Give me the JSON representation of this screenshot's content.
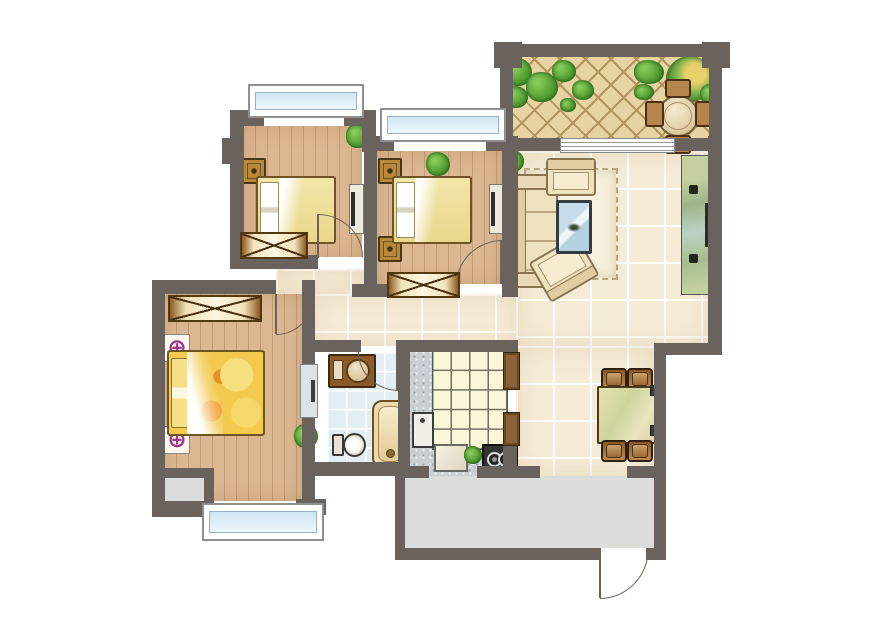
{
  "title": "apartment-floor-plan",
  "palette": {
    "wall": "#6a635d",
    "wood": "#dcb892",
    "tile": "#f5ecd8",
    "bathtile": "#e2edf4",
    "speckle": "#c9cfd3",
    "terrace": "#e7d4a2",
    "balcony": "#dcdcda",
    "glass": "#cfe5f2",
    "masterbed": "#f2ca4e",
    "lamp": "#a2348e",
    "doorline": "#6f6156"
  },
  "lamp_symbol": "⊕",
  "rooms": [
    {
      "name": "bedroom-1",
      "floor": "wood",
      "rect": [
        244,
        126,
        118,
        131
      ]
    },
    {
      "name": "bedroom-2",
      "floor": "wood",
      "rect": [
        377,
        151,
        125,
        133
      ]
    },
    {
      "name": "master-bedroom",
      "floor": "wood",
      "rect": [
        165,
        294,
        137,
        207
      ]
    },
    {
      "name": "alcove",
      "floor": "gray",
      "rect": [
        165,
        478,
        40,
        26
      ]
    },
    {
      "name": "corridor",
      "floor": "tile",
      "rect": [
        276,
        269,
        88,
        25
      ]
    },
    {
      "name": "hallway",
      "floor": "tile",
      "rect": [
        310,
        294,
        208,
        52
      ]
    },
    {
      "name": "living-room",
      "floor": "tile",
      "rect": [
        516,
        151,
        192,
        195
      ]
    },
    {
      "name": "dining-area",
      "floor": "tile",
      "rect": [
        516,
        346,
        138,
        130
      ]
    },
    {
      "name": "bathroom",
      "floor": "bath",
      "rect": [
        327,
        352,
        71,
        110
      ]
    },
    {
      "name": "kitchen",
      "floor": "speckle",
      "rect": [
        410,
        352,
        93,
        114
      ]
    },
    {
      "name": "kitchen-balcony-passage",
      "floor": "speckle",
      "rect": [
        429,
        466,
        48,
        12
      ]
    },
    {
      "name": "terrace",
      "floor": "herringbone",
      "rect": [
        513,
        57,
        196,
        81
      ]
    },
    {
      "name": "service-balcony",
      "floor": "gray",
      "rect": [
        405,
        476,
        249,
        72
      ]
    }
  ],
  "walls": [
    [
      230,
      110,
      34,
      16
    ],
    [
      344,
      110,
      32,
      16
    ],
    [
      230,
      110,
      14,
      159
    ],
    [
      222,
      138,
      8,
      26
    ],
    [
      362,
      110,
      14,
      42
    ],
    [
      364,
      136,
      13,
      161
    ],
    [
      364,
      136,
      30,
      15
    ],
    [
      486,
      136,
      32,
      15
    ],
    [
      502,
      136,
      16,
      156
    ],
    [
      230,
      255,
      88,
      14
    ],
    [
      352,
      284,
      38,
      13
    ],
    [
      502,
      272,
      16,
      25
    ],
    [
      152,
      280,
      124,
      14
    ],
    [
      152,
      280,
      13,
      237
    ],
    [
      302,
      280,
      13,
      237
    ],
    [
      152,
      501,
      60,
      16
    ],
    [
      296,
      499,
      30,
      16
    ],
    [
      160,
      468,
      52,
      10
    ],
    [
      204,
      468,
      10,
      44
    ],
    [
      315,
      340,
      46,
      12
    ],
    [
      396,
      340,
      20,
      12
    ],
    [
      398,
      340,
      12,
      134
    ],
    [
      313,
      462,
      92,
      14
    ],
    [
      410,
      340,
      106,
      12
    ],
    [
      503,
      340,
      15,
      14
    ],
    [
      503,
      444,
      14,
      24
    ],
    [
      403,
      466,
      26,
      12
    ],
    [
      477,
      466,
      63,
      12
    ],
    [
      627,
      466,
      39,
      12
    ],
    [
      395,
      466,
      10,
      94
    ],
    [
      403,
      548,
      197,
      12
    ],
    [
      646,
      548,
      20,
      12
    ],
    [
      654,
      346,
      12,
      214
    ],
    [
      654,
      343,
      68,
      12
    ],
    [
      708,
      136,
      14,
      219
    ],
    [
      498,
      44,
      226,
      13
    ],
    [
      500,
      44,
      13,
      98
    ],
    [
      709,
      44,
      13,
      98
    ],
    [
      494,
      42,
      28,
      26
    ],
    [
      702,
      42,
      28,
      26
    ],
    [
      500,
      138,
      62,
      13
    ],
    [
      672,
      138,
      50,
      13
    ]
  ],
  "windows": [
    {
      "name": "bay-window-bedroom-1",
      "rect": [
        248,
        84,
        112,
        30
      ]
    },
    {
      "name": "bay-window-bedroom-2",
      "rect": [
        380,
        108,
        122,
        30
      ]
    },
    {
      "name": "bay-window-master-bedroom",
      "rect": [
        202,
        503,
        118,
        34
      ]
    }
  ],
  "doors": [
    {
      "name": "door-bedroom-1",
      "box": [
        318,
        214,
        44,
        42
      ],
      "corner": "tr",
      "leaf": [
        317,
        214,
        2,
        44
      ]
    },
    {
      "name": "door-bedroom-2",
      "box": [
        456,
        240,
        46,
        44
      ],
      "corner": "tl",
      "leaf": [
        500,
        240,
        2,
        44
      ]
    },
    {
      "name": "door-master-bedroom",
      "box": [
        276,
        294,
        38,
        40
      ],
      "corner": "br",
      "leaf": [
        275,
        294,
        2,
        40
      ]
    },
    {
      "name": "door-bathroom",
      "box": [
        358,
        352,
        40,
        38
      ],
      "corner": "bl",
      "leaf": [
        396,
        352,
        2,
        38
      ]
    },
    {
      "name": "entry-door",
      "box": [
        600,
        548,
        48,
        50
      ],
      "corner": "br",
      "leaf": [
        599,
        548,
        2,
        50
      ]
    }
  ],
  "furniture": [
    {
      "kind": "slider",
      "name": "terrace-sliding-door",
      "rect": [
        560,
        138,
        113,
        13
      ]
    },
    {
      "kind": "plant",
      "name": "plant-bedroom-1",
      "rect": [
        346,
        124,
        24,
        24
      ]
    },
    {
      "kind": "nightstand",
      "name": "nightstand",
      "rect": [
        242,
        158,
        20,
        22
      ]
    },
    {
      "kind": "nightstand",
      "name": "nightstand",
      "rect": [
        242,
        236,
        20,
        22
      ]
    },
    {
      "kind": "bed",
      "name": "bed-bedroom-1",
      "rect": [
        256,
        176,
        76,
        64
      ]
    },
    {
      "kind": "tv-board",
      "name": "tv-board-bedroom-1",
      "rect": [
        349,
        184,
        13,
        48
      ]
    },
    {
      "kind": "wardrobe",
      "name": "wardrobe-bedroom-1",
      "rect": [
        240,
        232,
        64,
        23
      ]
    },
    {
      "kind": "plant",
      "name": "plant-bedroom-2",
      "rect": [
        426,
        152,
        24,
        24
      ]
    },
    {
      "kind": "nightstand",
      "name": "nightstand",
      "rect": [
        378,
        158,
        20,
        22
      ]
    },
    {
      "kind": "nightstand",
      "name": "nightstand",
      "rect": [
        378,
        236,
        20,
        22
      ]
    },
    {
      "kind": "bed",
      "name": "bed-bedroom-2",
      "rect": [
        392,
        176,
        76,
        64
      ]
    },
    {
      "kind": "tv-board",
      "name": "tv-board-bedroom-2",
      "rect": [
        489,
        184,
        13,
        48
      ]
    },
    {
      "kind": "wardrobe",
      "name": "wardrobe-bedroom-2",
      "rect": [
        387,
        272,
        69,
        22
      ]
    },
    {
      "kind": "wardrobe",
      "name": "wardrobe-master",
      "rect": [
        168,
        295,
        90,
        23
      ]
    },
    {
      "kind": "lamp-target",
      "name": "lamp-symbol",
      "rect": [
        164,
        334,
        24,
        26
      ]
    },
    {
      "kind": "lamp-target",
      "name": "lamp-symbol",
      "rect": [
        164,
        426,
        24,
        26
      ]
    },
    {
      "kind": "bed-master",
      "name": "bed-master",
      "rect": [
        167,
        350,
        94,
        82
      ]
    },
    {
      "kind": "plant",
      "name": "plant-master",
      "rect": [
        294,
        424,
        24,
        24
      ]
    },
    {
      "kind": "cabinet",
      "name": "cabinet-master-wall",
      "rect": [
        300,
        364,
        16,
        52
      ]
    },
    {
      "kind": "vanity",
      "name": "bathroom-vanity",
      "rect": [
        328,
        354,
        44,
        30
      ]
    },
    {
      "kind": "toilet",
      "name": "toilet",
      "rect": [
        332,
        432,
        34,
        26
      ]
    },
    {
      "kind": "bathtub",
      "name": "bathtub",
      "rect": [
        372,
        400,
        32,
        64
      ]
    },
    {
      "kind": "counter-grid",
      "name": "kitchen-counter",
      "rect": [
        432,
        350,
        74,
        98
      ]
    },
    {
      "kind": "sink",
      "name": "kitchen-sink",
      "rect": [
        412,
        412,
        18,
        32
      ]
    },
    {
      "kind": "cutting-board",
      "name": "cutting-board",
      "rect": [
        434,
        444,
        30,
        24
      ]
    },
    {
      "kind": "plant",
      "name": "plant-kitchen",
      "rect": [
        464,
        446,
        18,
        18
      ]
    },
    {
      "kind": "stove",
      "name": "stove",
      "rect": [
        482,
        444,
        32,
        24
      ]
    },
    {
      "kind": "cabinet-frame",
      "name": "kitchen-door-frame",
      "rect": [
        503,
        352,
        15,
        36
      ]
    },
    {
      "kind": "cabinet-frame",
      "name": "kitchen-door-frame",
      "rect": [
        503,
        412,
        15,
        32
      ]
    },
    {
      "kind": "rug",
      "name": "living-room-rug",
      "rect": [
        524,
        168,
        90,
        108
      ]
    },
    {
      "kind": "sofa",
      "name": "sofa",
      "rect": [
        514,
        182,
        40,
        92
      ]
    },
    {
      "kind": "sofa-arm",
      "name": "sofa-armrest",
      "rect": [
        510,
        174,
        46,
        12
      ]
    },
    {
      "kind": "sofa-arm",
      "name": "sofa-armrest",
      "rect": [
        510,
        272,
        46,
        12
      ]
    },
    {
      "kind": "armchair",
      "name": "armchair",
      "rect": [
        546,
        158,
        46,
        34
      ]
    },
    {
      "kind": "armchair",
      "name": "armchair",
      "rect": [
        536,
        246,
        52,
        42
      ],
      "rot": 150
    },
    {
      "kind": "coffee-table",
      "name": "coffee-table",
      "rect": [
        556,
        200,
        30,
        48
      ]
    },
    {
      "kind": "plant",
      "name": "plant-living-room",
      "rect": [
        502,
        150,
        22,
        22
      ]
    },
    {
      "kind": "tv-cabinet",
      "name": "tv-cabinet",
      "rect": [
        681,
        155,
        29,
        138
      ]
    },
    {
      "kind": "speaker",
      "name": "speaker",
      "rect": [
        689,
        185,
        9,
        9
      ]
    },
    {
      "kind": "speaker",
      "name": "speaker",
      "rect": [
        689,
        254,
        9,
        9
      ]
    },
    {
      "kind": "chair",
      "name": "dining-chair",
      "rect": [
        601,
        368,
        22,
        18
      ]
    },
    {
      "kind": "chair",
      "name": "dining-chair",
      "rect": [
        627,
        368,
        22,
        18
      ]
    },
    {
      "kind": "dining-table",
      "name": "dining-table",
      "rect": [
        597,
        386,
        60,
        54
      ]
    },
    {
      "kind": "chair",
      "name": "dining-chair",
      "rect": [
        601,
        440,
        22,
        18
      ]
    },
    {
      "kind": "chair",
      "name": "dining-chair",
      "rect": [
        627,
        440,
        22,
        18
      ]
    },
    {
      "kind": "outlet",
      "name": "wall-outlet",
      "rect": [
        650,
        385,
        8,
        9
      ]
    },
    {
      "kind": "outlet",
      "name": "wall-outlet",
      "rect": [
        650,
        425,
        8,
        9
      ]
    },
    {
      "kind": "plant",
      "name": "terrace-plant",
      "rect": [
        504,
        58,
        28,
        28
      ]
    },
    {
      "kind": "plant",
      "name": "terrace-plant",
      "rect": [
        526,
        72,
        32,
        30
      ]
    },
    {
      "kind": "plant",
      "name": "terrace-plant",
      "rect": [
        552,
        60,
        24,
        22
      ]
    },
    {
      "kind": "plant",
      "name": "terrace-plant",
      "rect": [
        572,
        80,
        22,
        20
      ]
    },
    {
      "kind": "plant",
      "name": "terrace-plant",
      "rect": [
        504,
        86,
        24,
        22
      ]
    },
    {
      "kind": "plant",
      "name": "terrace-plant",
      "rect": [
        560,
        98,
        16,
        14
      ]
    },
    {
      "kind": "plant",
      "name": "terrace-plant",
      "rect": [
        634,
        60,
        30,
        24
      ]
    },
    {
      "kind": "tree",
      "name": "terrace-tree",
      "rect": [
        666,
        56,
        48,
        46
      ]
    },
    {
      "kind": "plant",
      "name": "terrace-plant",
      "rect": [
        700,
        84,
        22,
        20
      ]
    },
    {
      "kind": "plant",
      "name": "terrace-plant",
      "rect": [
        634,
        84,
        20,
        16
      ]
    },
    {
      "kind": "round-table",
      "name": "terrace-table",
      "rect": [
        657,
        95,
        38,
        38
      ]
    },
    {
      "kind": "tchair",
      "name": "terrace-chair",
      "rect": [
        665,
        79,
        22,
        15
      ]
    },
    {
      "kind": "tchair",
      "name": "terrace-chair",
      "rect": [
        665,
        135,
        22,
        15
      ]
    },
    {
      "kind": "tchair",
      "name": "terrace-chair",
      "rect": [
        645,
        101,
        15,
        22
      ]
    },
    {
      "kind": "tchair",
      "name": "terrace-chair",
      "rect": [
        695,
        101,
        15,
        22
      ]
    }
  ]
}
